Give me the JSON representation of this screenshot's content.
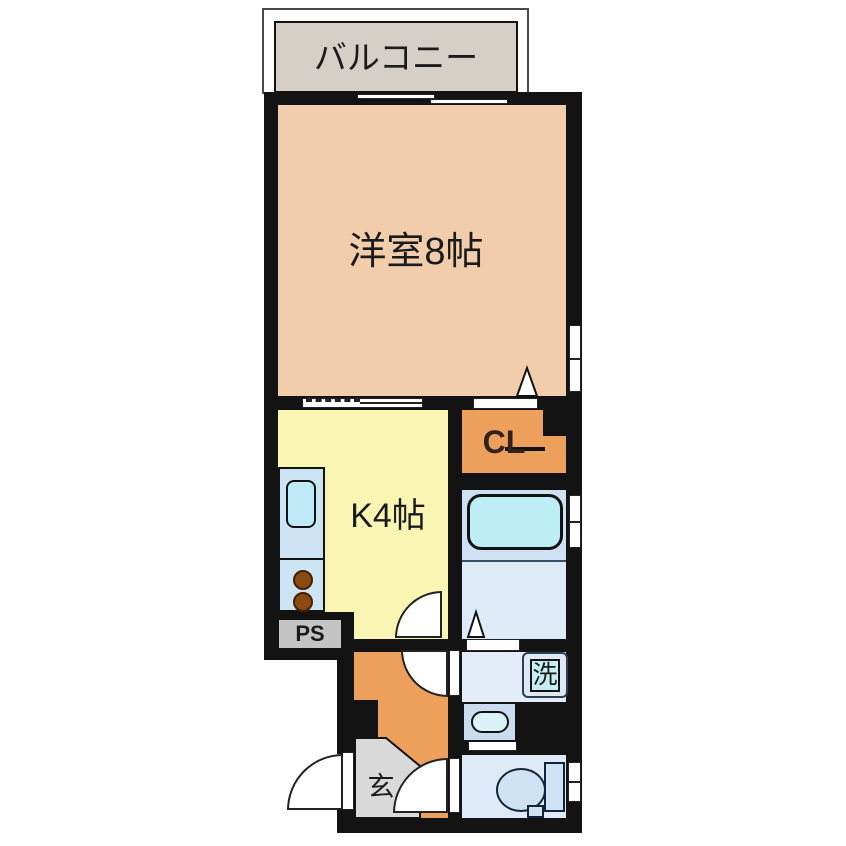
{
  "plan": {
    "type": "japanese-apartment-floorplan",
    "labels": {
      "balcony": "バルコニー",
      "main_room": "洋室8帖",
      "kitchen": "K4帖",
      "closet": "CL",
      "pipe_space": "PS",
      "entrance": "玄",
      "laundry": "洗"
    },
    "colors": {
      "wall": "#131313",
      "main_room": "#f2cdab",
      "kitchen": "#f9f6b3",
      "closet_orange": "#eda05c",
      "hallway_orange": "#eda05c",
      "balcony_gray": "#d6cfc8",
      "ps_gray": "#c4c4c4",
      "entrance_gray": "#d9d9d9",
      "counter_blue": "#cde4f4",
      "sink_cyan": "#bdeaf6",
      "bath_upper": "#cfe0f2",
      "bath_lower": "#dfeaf8",
      "tub_cyan": "#bdeef6",
      "wash_room": "#e3ecf8",
      "laundry_box": "#c6eef2",
      "vanity_blue": "#c9dcf0",
      "vanity_oval": "#d9f3f8",
      "toilet_room": "#dfeaf8",
      "toilet_fixture": "#cfe2f4",
      "burner_brown": "#8a4a10"
    }
  }
}
